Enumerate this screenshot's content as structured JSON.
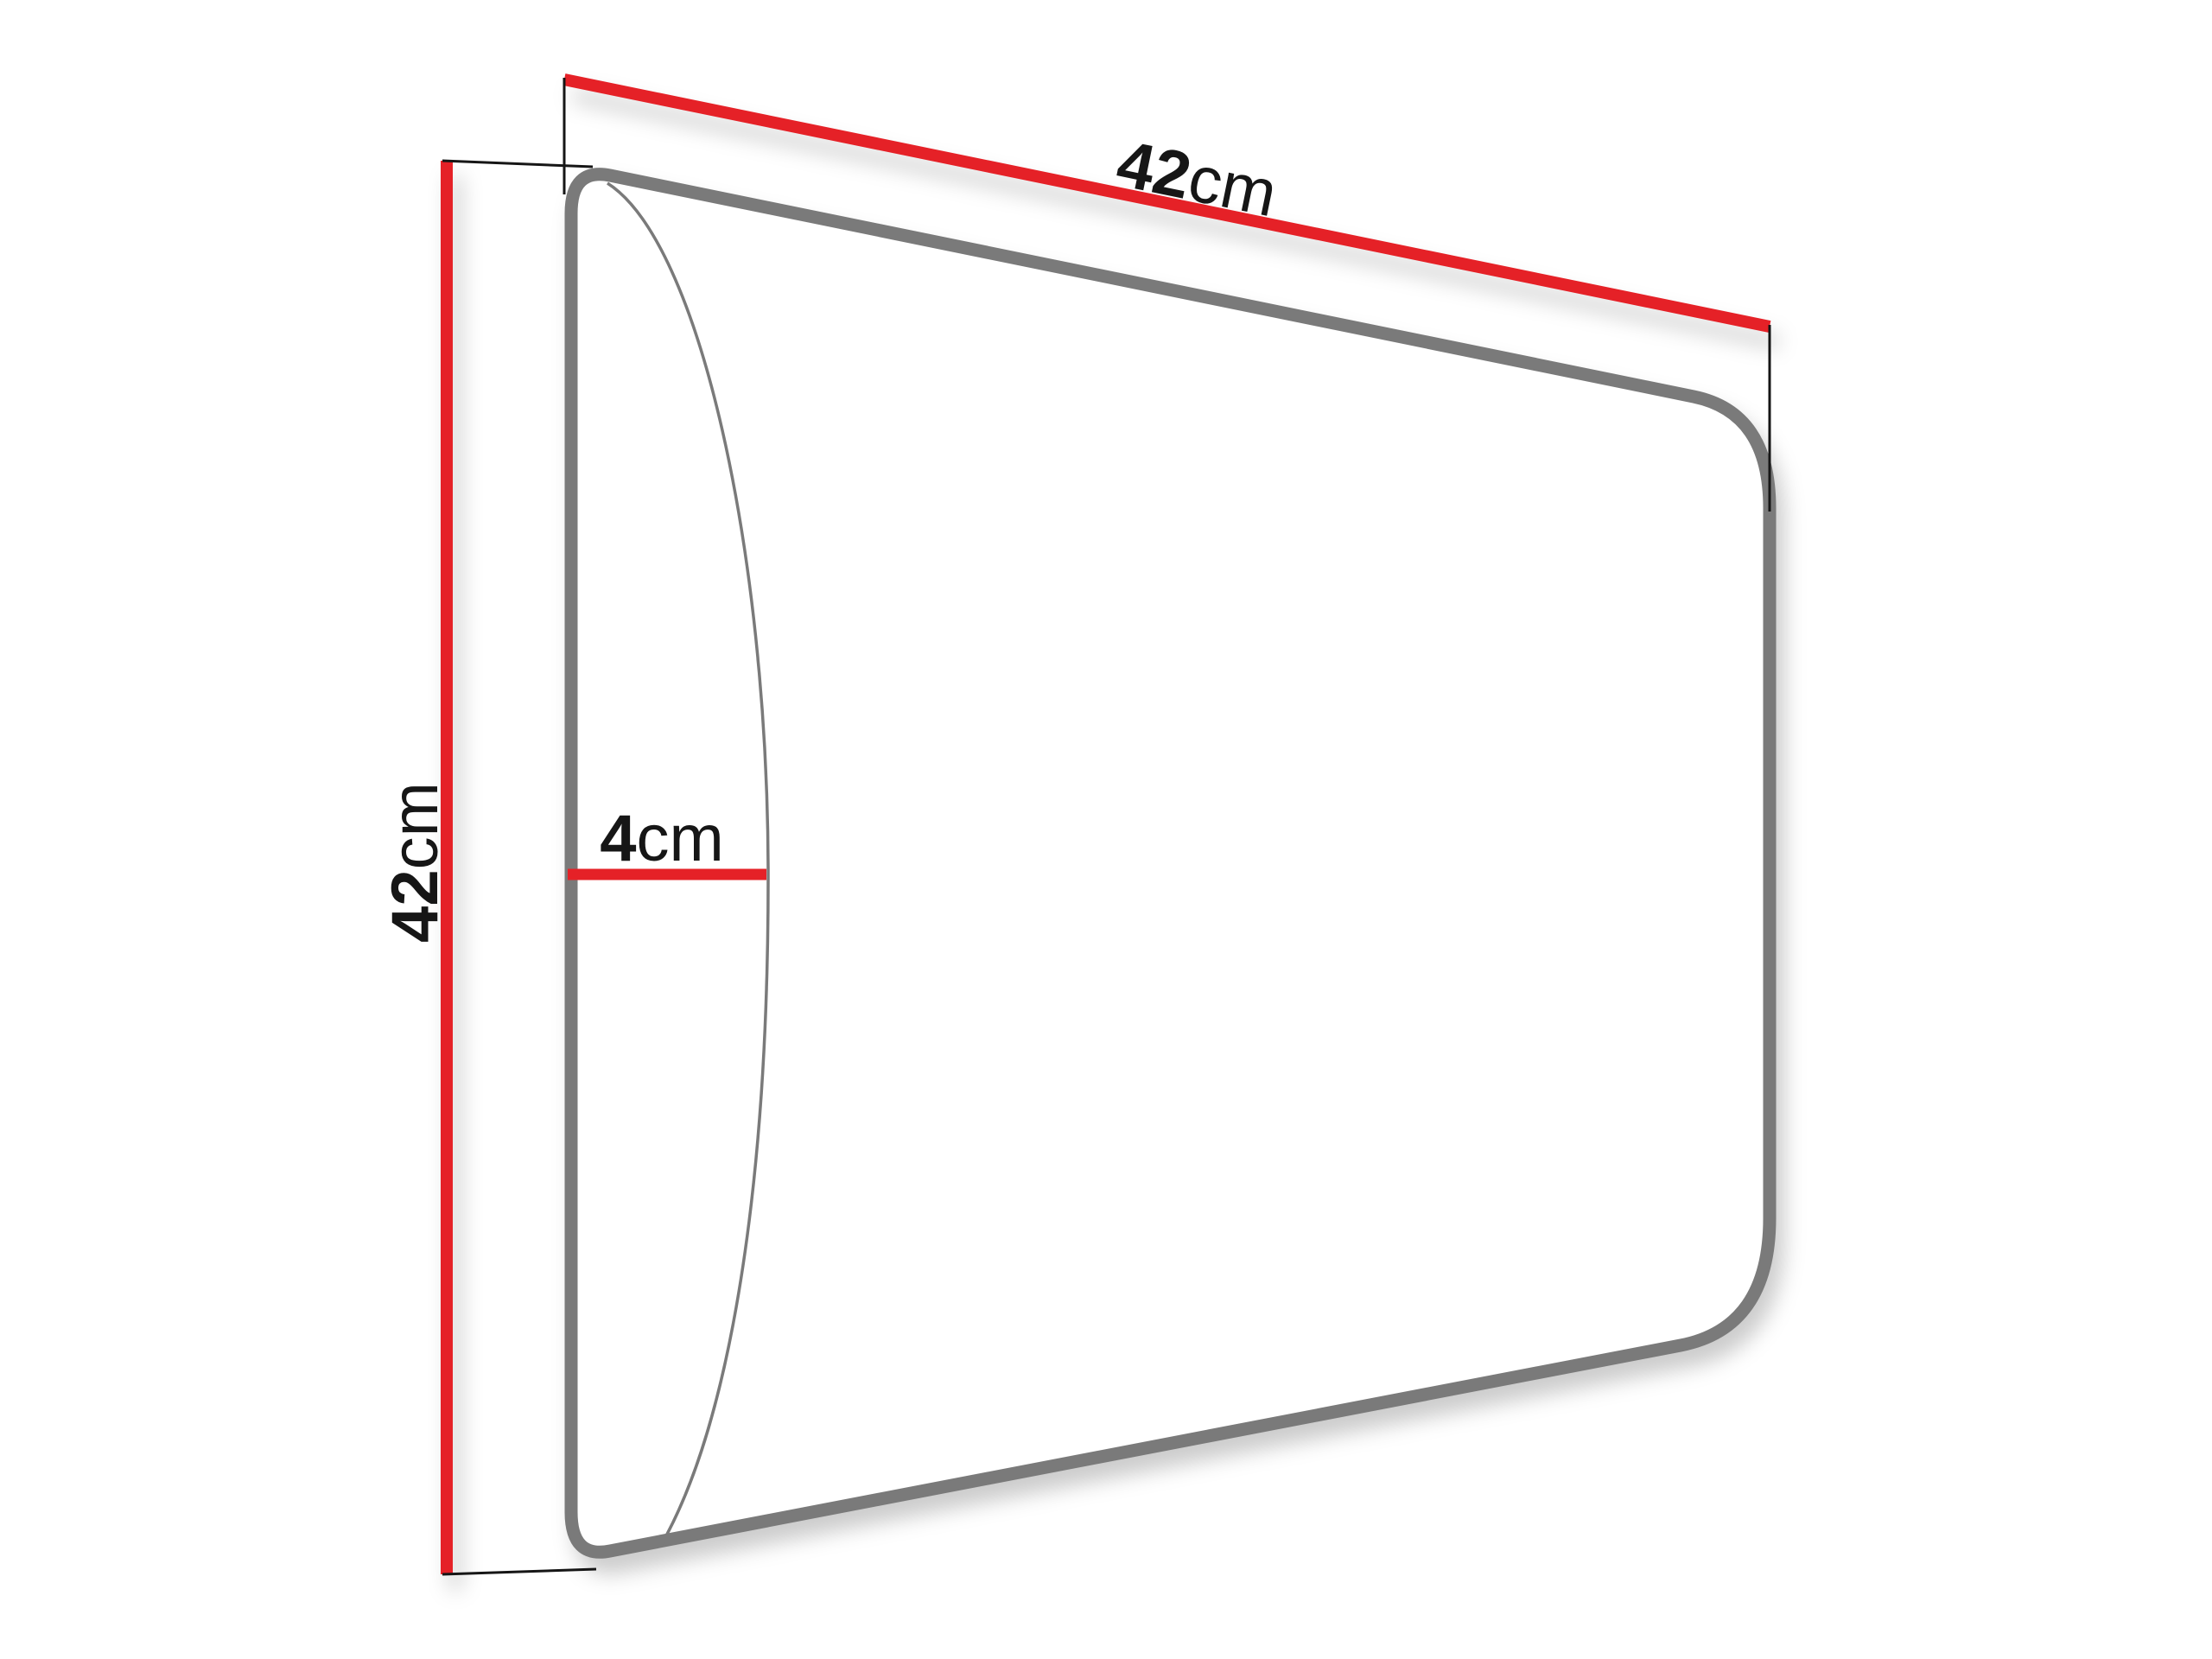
{
  "diagram": {
    "type": "dimension-drawing",
    "subject": "upholstered wall panel",
    "labels": {
      "width": {
        "value": "42",
        "unit": "cm"
      },
      "height": {
        "value": "42",
        "unit": "cm"
      },
      "depth": {
        "value": "4",
        "unit": "cm"
      }
    },
    "colors": {
      "background": "#ffffff",
      "dimension_line": "#e52127",
      "panel_outline": "#7a7a7a",
      "extension_line": "#161616",
      "label_text": "#161616"
    }
  }
}
